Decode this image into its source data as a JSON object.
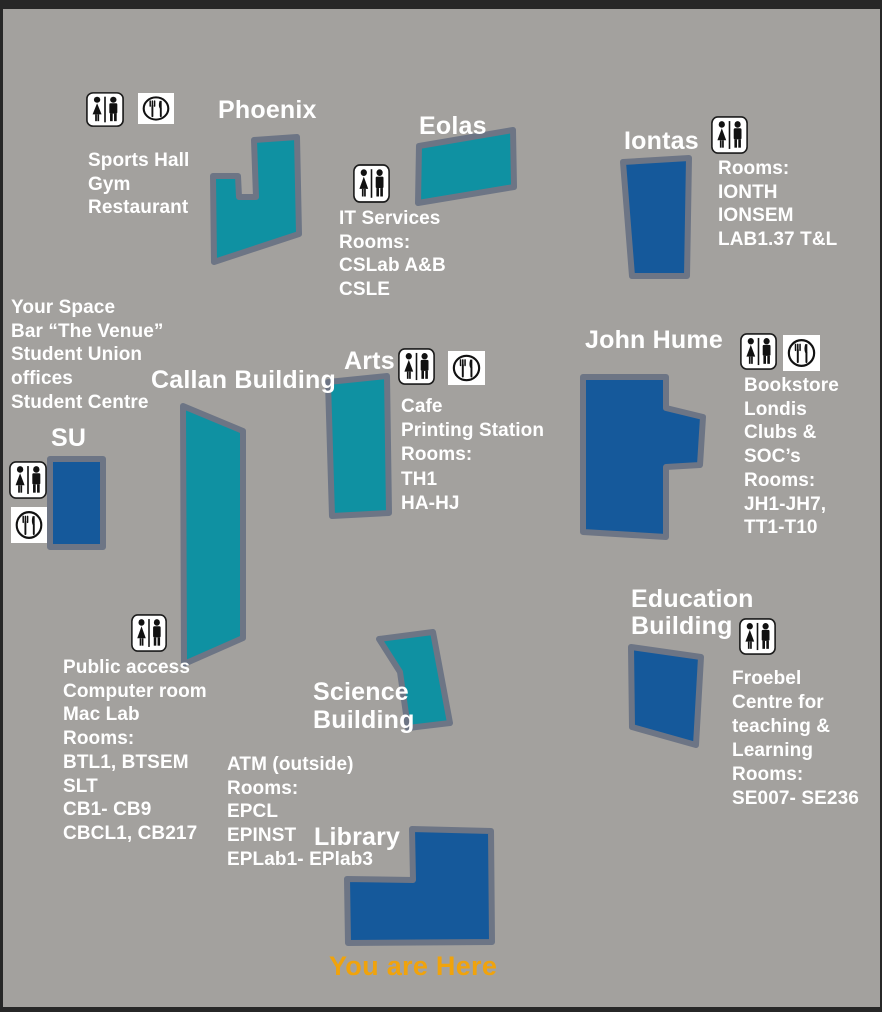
{
  "colors": {
    "frame": "#272727",
    "map_bg": "#a3a19e",
    "teal": "#0f91a2",
    "blue": "#15599b",
    "outline": "#6d7585",
    "label": "#ffffff",
    "marker": "#f0a30c"
  },
  "buildings": {
    "phoenix": {
      "name": "Phoenix",
      "color": "teal",
      "icons": [
        "restroom-icon",
        "restaurant-icon"
      ],
      "info": [
        "Sports Hall",
        "Gym",
        "Restaurant"
      ]
    },
    "eolas": {
      "name": "Eolas",
      "color": "teal",
      "icons": [
        "restroom-icon"
      ],
      "info": [
        "IT Services",
        "Rooms:",
        "CSLab A&B",
        "CSLE"
      ]
    },
    "iontas": {
      "name": "Iontas",
      "color": "blue",
      "icons": [
        "restroom-icon"
      ],
      "info": [
        "Rooms:",
        "IONTH",
        "IONSEM",
        "LAB1.37 T&L"
      ]
    },
    "su": {
      "name": "SU",
      "color": "blue",
      "icons": [
        "restroom-icon",
        "restaurant-icon"
      ],
      "info": [
        "Your Space",
        "Bar “The Venue”",
        "Student Union",
        "offices",
        "Student Centre"
      ]
    },
    "callan": {
      "name": "Callan Building",
      "color": "teal",
      "icons": [
        "restroom-icon"
      ],
      "info": [
        "Public access",
        "Computer room",
        "Mac Lab",
        "Rooms:",
        "BTL1, BTSEM",
        "SLT",
        "CB1- CB9",
        "CBCL1, CB217"
      ]
    },
    "arts": {
      "name": "Arts",
      "color": "teal",
      "icons": [
        "restroom-icon",
        "restaurant-icon"
      ],
      "info": [
        "Cafe",
        "Printing Station",
        "Rooms:",
        "TH1",
        "HA-HJ"
      ]
    },
    "john_hume": {
      "name": "John Hume",
      "color": "blue",
      "icons": [
        "restroom-icon",
        "restaurant-icon"
      ],
      "info": [
        "Bookstore",
        "Londis",
        "Clubs &",
        "SOC’s",
        "Rooms:",
        "JH1-JH7,",
        "TT1-T10"
      ]
    },
    "education": {
      "name": [
        "Education",
        "Building"
      ],
      "color": "blue",
      "icons": [
        "restroom-icon"
      ],
      "info": [
        "Froebel",
        "Centre for",
        "teaching &",
        "Learning",
        "Rooms:",
        "SE007- SE236"
      ]
    },
    "science": {
      "name": [
        "Science",
        "Building"
      ],
      "color": "teal",
      "icons": [],
      "info": [
        "ATM (outside)",
        "Rooms:",
        "EPCL",
        "EPINST",
        "EPLab1- EPlab3"
      ]
    },
    "library": {
      "name": "Library",
      "color": "blue",
      "icons": [],
      "info": []
    }
  },
  "marker": {
    "label": "You are Here"
  }
}
